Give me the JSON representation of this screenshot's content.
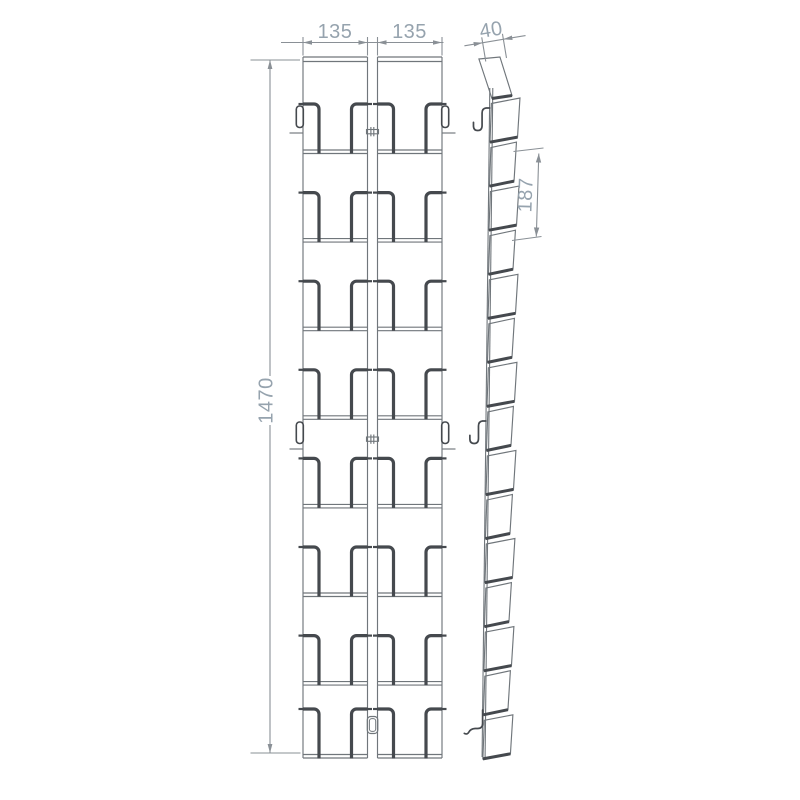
{
  "drawing": {
    "type": "technical-drawing",
    "product": "wall-mounted two-column leaflet dispenser, front view and side view",
    "front_view": {
      "columns": 2,
      "rows": 8,
      "wall_hook_rows": 2,
      "column_connectors": 2
    },
    "side_view": {
      "panels": 16,
      "wall_hooks": 3
    },
    "dimensions": {
      "column_width_left": "135",
      "column_width_right": "135",
      "top_depth": "40",
      "pocket_pitch": "187",
      "total_height": "1470"
    },
    "colors": {
      "line_thin": "#70767b",
      "line_thick": "#45494e",
      "dim_line": "#8a9096",
      "dim_text": "#96a3ae",
      "background": "#ffffff"
    }
  }
}
